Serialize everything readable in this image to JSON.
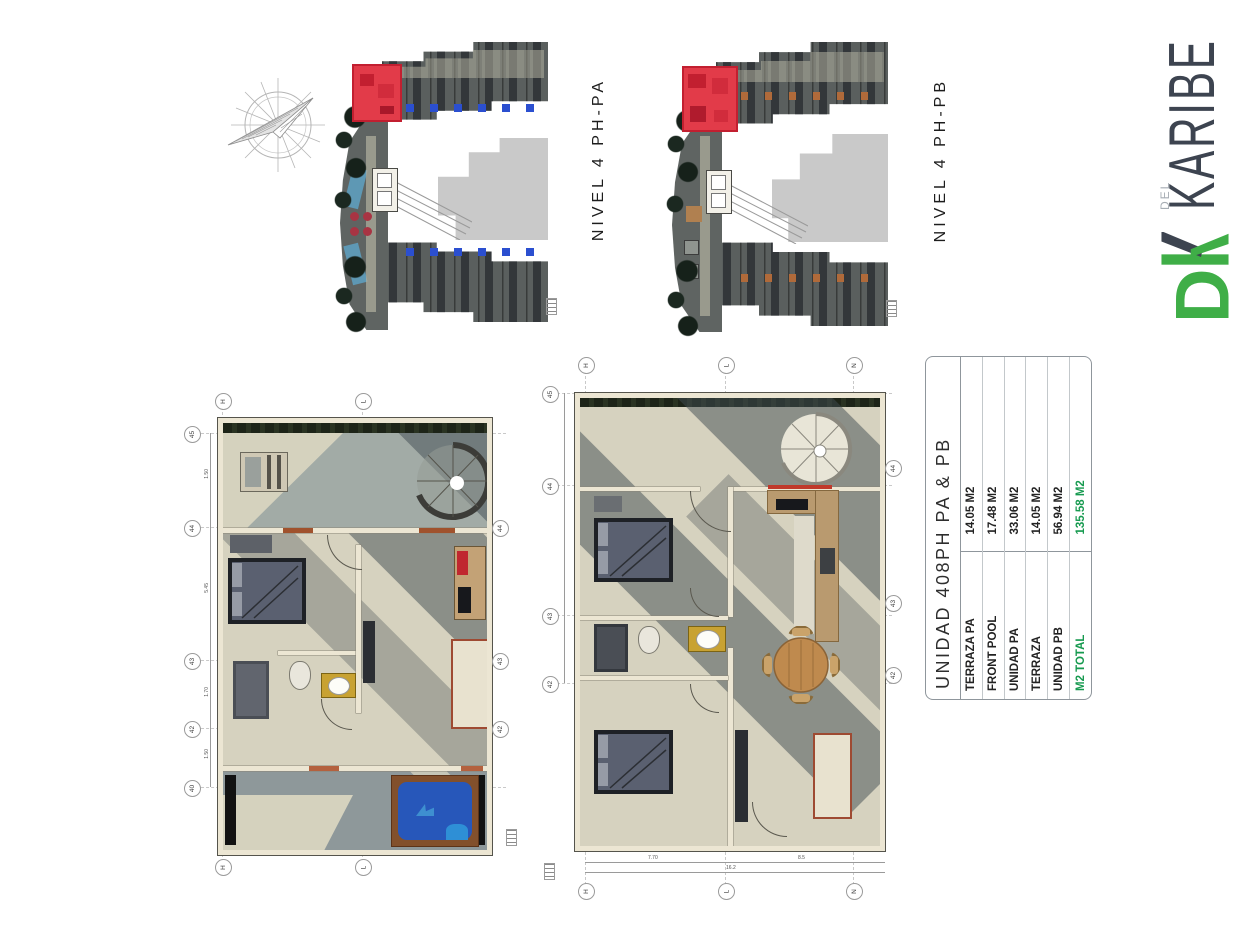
{
  "logo": {
    "dk": "DK",
    "del": "DEL",
    "brand": "KARIBE",
    "green": "#3fae47",
    "dark": "#3d4450"
  },
  "site_plans": {
    "pa": {
      "label": "NIVEL 4 PH-PA",
      "highlight_color": "#e23b49",
      "pool_dot_color": "#2b4fd0"
    },
    "pb": {
      "label": "NIVEL 4 PH-PB",
      "highlight_color": "#e23b49",
      "accent_dot_color": "#b06a3a"
    }
  },
  "floor_plans": {
    "pa": {
      "grid_top": [
        "H",
        "L"
      ],
      "grid_bottom": [
        "H",
        "L"
      ],
      "grid_left": [
        "45",
        "44",
        "43",
        "42",
        "40"
      ],
      "grid_right": [
        "44",
        "43",
        "42"
      ],
      "dims_left": [
        "1.50",
        "5.45",
        "1.70",
        "1.50"
      ],
      "pool_color": "#2757ba",
      "deck_color": "#82502c"
    },
    "pb": {
      "grid_top": [
        "H",
        "L",
        "N"
      ],
      "grid_bottom": [
        "H",
        "L",
        "N"
      ],
      "grid_left": [
        "45",
        "44",
        "43",
        "42"
      ],
      "grid_right": [
        "44",
        "43",
        "42"
      ],
      "dims_bottom": [
        "7.70",
        "8.5",
        "16.2"
      ]
    }
  },
  "area_table": {
    "title": "UNIDAD 408PH PA & PB",
    "rows": [
      {
        "label": "TERRAZA PA",
        "value": "14.05 M2"
      },
      {
        "label": "FRONT POOL",
        "value": "17.48 M2"
      },
      {
        "label": "UNIDAD PA",
        "value": "33.06 M2"
      },
      {
        "label": "TERRAZA",
        "value": "14.05 M2"
      },
      {
        "label": "UNIDAD PB",
        "value": "56.94 M2"
      },
      {
        "label": "M2 TOTAL",
        "value": "135.58 M2"
      }
    ],
    "highlight_color": "#169a4f"
  }
}
